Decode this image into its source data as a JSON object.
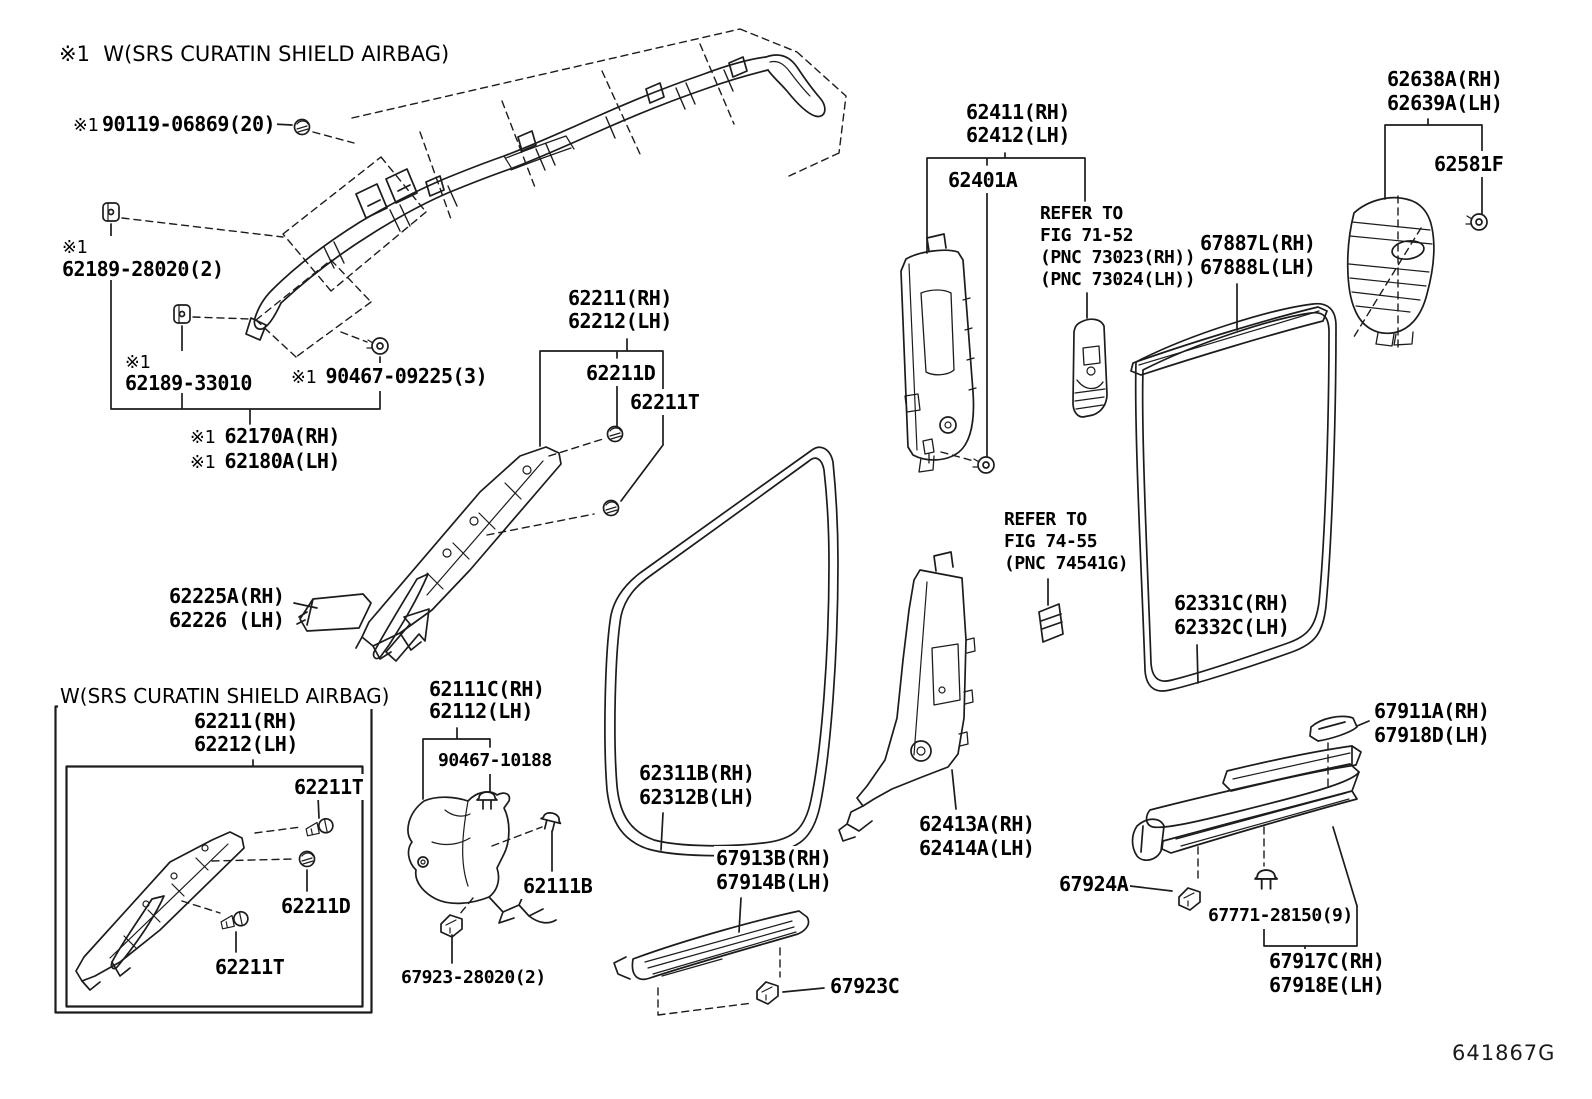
{
  "diagram": {
    "figure_code": "641867G",
    "line_color": "#1c1c1c",
    "labels": [
      {
        "name": "note-srs",
        "font": "sans",
        "x": 57,
        "y": 42,
        "size": 21,
        "lines": [
          {
            "t": "※1  W(SRS CURATIN SHIELD AIRBAG)"
          }
        ]
      },
      {
        "name": "90119-06869",
        "x": 71,
        "y": 111,
        "lines": [
          {
            "pre": "※1",
            "t": "90119-06869(20)"
          }
        ]
      },
      {
        "name": "62189-28020",
        "x": 60,
        "y": 236,
        "lh": 21,
        "lines": [
          {
            "pre": "※1",
            "t": ""
          },
          {
            "t": "62189-28020(2)"
          }
        ]
      },
      {
        "name": "62189-33010",
        "x": 123,
        "y": 351,
        "lh": 20,
        "lines": [
          {
            "pre": "※1",
            "t": ""
          },
          {
            "t": "62189-33010"
          }
        ]
      },
      {
        "name": "90467-09225",
        "x": 289,
        "y": 363,
        "lines": [
          {
            "pre": "※1 ",
            "t": "90467-09225(3)"
          }
        ]
      },
      {
        "name": "62170A",
        "x": 188,
        "y": 425,
        "lh": 23,
        "lines": [
          {
            "pre": "※1 ",
            "t": "62170A(RH)"
          },
          {
            "pre": "※1 ",
            "t": "62180A(LH)"
          }
        ]
      },
      {
        "name": "62211-main",
        "x": 566,
        "y": 287,
        "lh": 23,
        "lines": [
          {
            "t": "62211(RH)"
          },
          {
            "t": "62212(LH)"
          }
        ]
      },
      {
        "name": "62211D-main",
        "x": 584,
        "y": 360,
        "lines": [
          {
            "t": "62211D"
          }
        ]
      },
      {
        "name": "62211T-main",
        "x": 628,
        "y": 389,
        "lines": [
          {
            "t": "62211T"
          }
        ]
      },
      {
        "name": "62225A",
        "x": 167,
        "y": 584,
        "lh": 24,
        "lines": [
          {
            "t": "62225A(RH)"
          },
          {
            "t": "62226 (LH)"
          }
        ]
      },
      {
        "name": "box-note-srs",
        "font": "sans",
        "x": 58,
        "y": 684,
        "size": 20,
        "lines": [
          {
            "t": "W(SRS CURATIN SHIELD AIRBAG)"
          }
        ]
      },
      {
        "name": "62211-box",
        "x": 192,
        "y": 710,
        "lh": 23,
        "lines": [
          {
            "t": "62211(RH)"
          },
          {
            "t": "62212(LH)"
          }
        ]
      },
      {
        "name": "62211T-box-top",
        "x": 292,
        "y": 774,
        "lines": [
          {
            "t": "62211T"
          }
        ]
      },
      {
        "name": "62211D-box",
        "x": 279,
        "y": 893,
        "lines": [
          {
            "t": "62211D"
          }
        ]
      },
      {
        "name": "62211T-box-bottom",
        "x": 213,
        "y": 954,
        "lines": [
          {
            "t": "62211T"
          }
        ]
      },
      {
        "name": "62111C",
        "x": 427,
        "y": 678,
        "lh": 22,
        "lines": [
          {
            "t": "62111C(RH)"
          },
          {
            "t": "62112(LH)"
          }
        ]
      },
      {
        "name": "90467-10188",
        "x": 436,
        "y": 748,
        "size": 18,
        "lines": [
          {
            "t": "90467-10188"
          }
        ]
      },
      {
        "name": "62111B",
        "x": 521,
        "y": 873,
        "lines": [
          {
            "t": "62111B"
          }
        ]
      },
      {
        "name": "67923-28020",
        "x": 399,
        "y": 965,
        "size": 18,
        "lines": [
          {
            "t": "67923-28020(2)"
          }
        ]
      },
      {
        "name": "62311B",
        "x": 637,
        "y": 761,
        "lh": 24,
        "lines": [
          {
            "t": "62311B(RH)"
          },
          {
            "t": "62312B(LH)"
          }
        ]
      },
      {
        "name": "67913B",
        "x": 714,
        "y": 846,
        "lh": 24,
        "lines": [
          {
            "t": "67913B(RH)"
          },
          {
            "t": "67914B(LH)"
          }
        ]
      },
      {
        "name": "67923C",
        "x": 828,
        "y": 973,
        "lines": [
          {
            "t": "67923C"
          }
        ]
      },
      {
        "name": "62411",
        "x": 964,
        "y": 101,
        "lh": 23,
        "lines": [
          {
            "t": "62411(RH)"
          },
          {
            "t": "62412(LH)"
          }
        ]
      },
      {
        "name": "62401A",
        "x": 946,
        "y": 167,
        "lines": [
          {
            "t": "62401A"
          }
        ]
      },
      {
        "name": "refer-71-52",
        "x": 1038,
        "y": 203,
        "size": 18,
        "lh": 22,
        "lines": [
          {
            "t": "REFER TO"
          },
          {
            "t": "FIG 71-52"
          },
          {
            "t": "(PNC 73023(RH))"
          },
          {
            "t": "(PNC 73024(LH))"
          }
        ]
      },
      {
        "name": "67887L",
        "x": 1198,
        "y": 231,
        "lh": 24,
        "lines": [
          {
            "t": "67887L(RH)"
          },
          {
            "t": "67888L(LH)"
          }
        ]
      },
      {
        "name": "62638A",
        "x": 1385,
        "y": 67,
        "lh": 24,
        "lines": [
          {
            "t": "62638A(RH)"
          },
          {
            "t": "62639A(LH)"
          }
        ]
      },
      {
        "name": "62581F",
        "x": 1432,
        "y": 151,
        "lines": [
          {
            "t": "62581F"
          }
        ]
      },
      {
        "name": "refer-74-55",
        "x": 1002,
        "y": 509,
        "size": 18,
        "lh": 22,
        "lines": [
          {
            "t": "REFER TO"
          },
          {
            "t": "FIG 74-55"
          },
          {
            "t": "(PNC 74541G)"
          }
        ]
      },
      {
        "name": "62331C",
        "x": 1172,
        "y": 591,
        "lh": 24,
        "lines": [
          {
            "t": "62331C(RH)"
          },
          {
            "t": "62332C(LH)"
          }
        ]
      },
      {
        "name": "62413A",
        "x": 917,
        "y": 812,
        "lh": 24,
        "lines": [
          {
            "t": "62413A(RH)"
          },
          {
            "t": "62414A(LH)"
          }
        ]
      },
      {
        "name": "67911A",
        "x": 1372,
        "y": 699,
        "lh": 24,
        "lines": [
          {
            "t": "67911A(RH)"
          },
          {
            "t": "67918D(LH)"
          }
        ]
      },
      {
        "name": "67924A",
        "x": 1057,
        "y": 871,
        "lines": [
          {
            "t": "67924A"
          }
        ]
      },
      {
        "name": "67771-28150",
        "x": 1206,
        "y": 903,
        "size": 18,
        "lines": [
          {
            "t": "67771-28150(9)"
          }
        ]
      },
      {
        "name": "67917C",
        "x": 1267,
        "y": 949,
        "lh": 24,
        "lines": [
          {
            "t": "67917C(RH)"
          },
          {
            "t": "67918E(LH)"
          }
        ]
      }
    ]
  }
}
